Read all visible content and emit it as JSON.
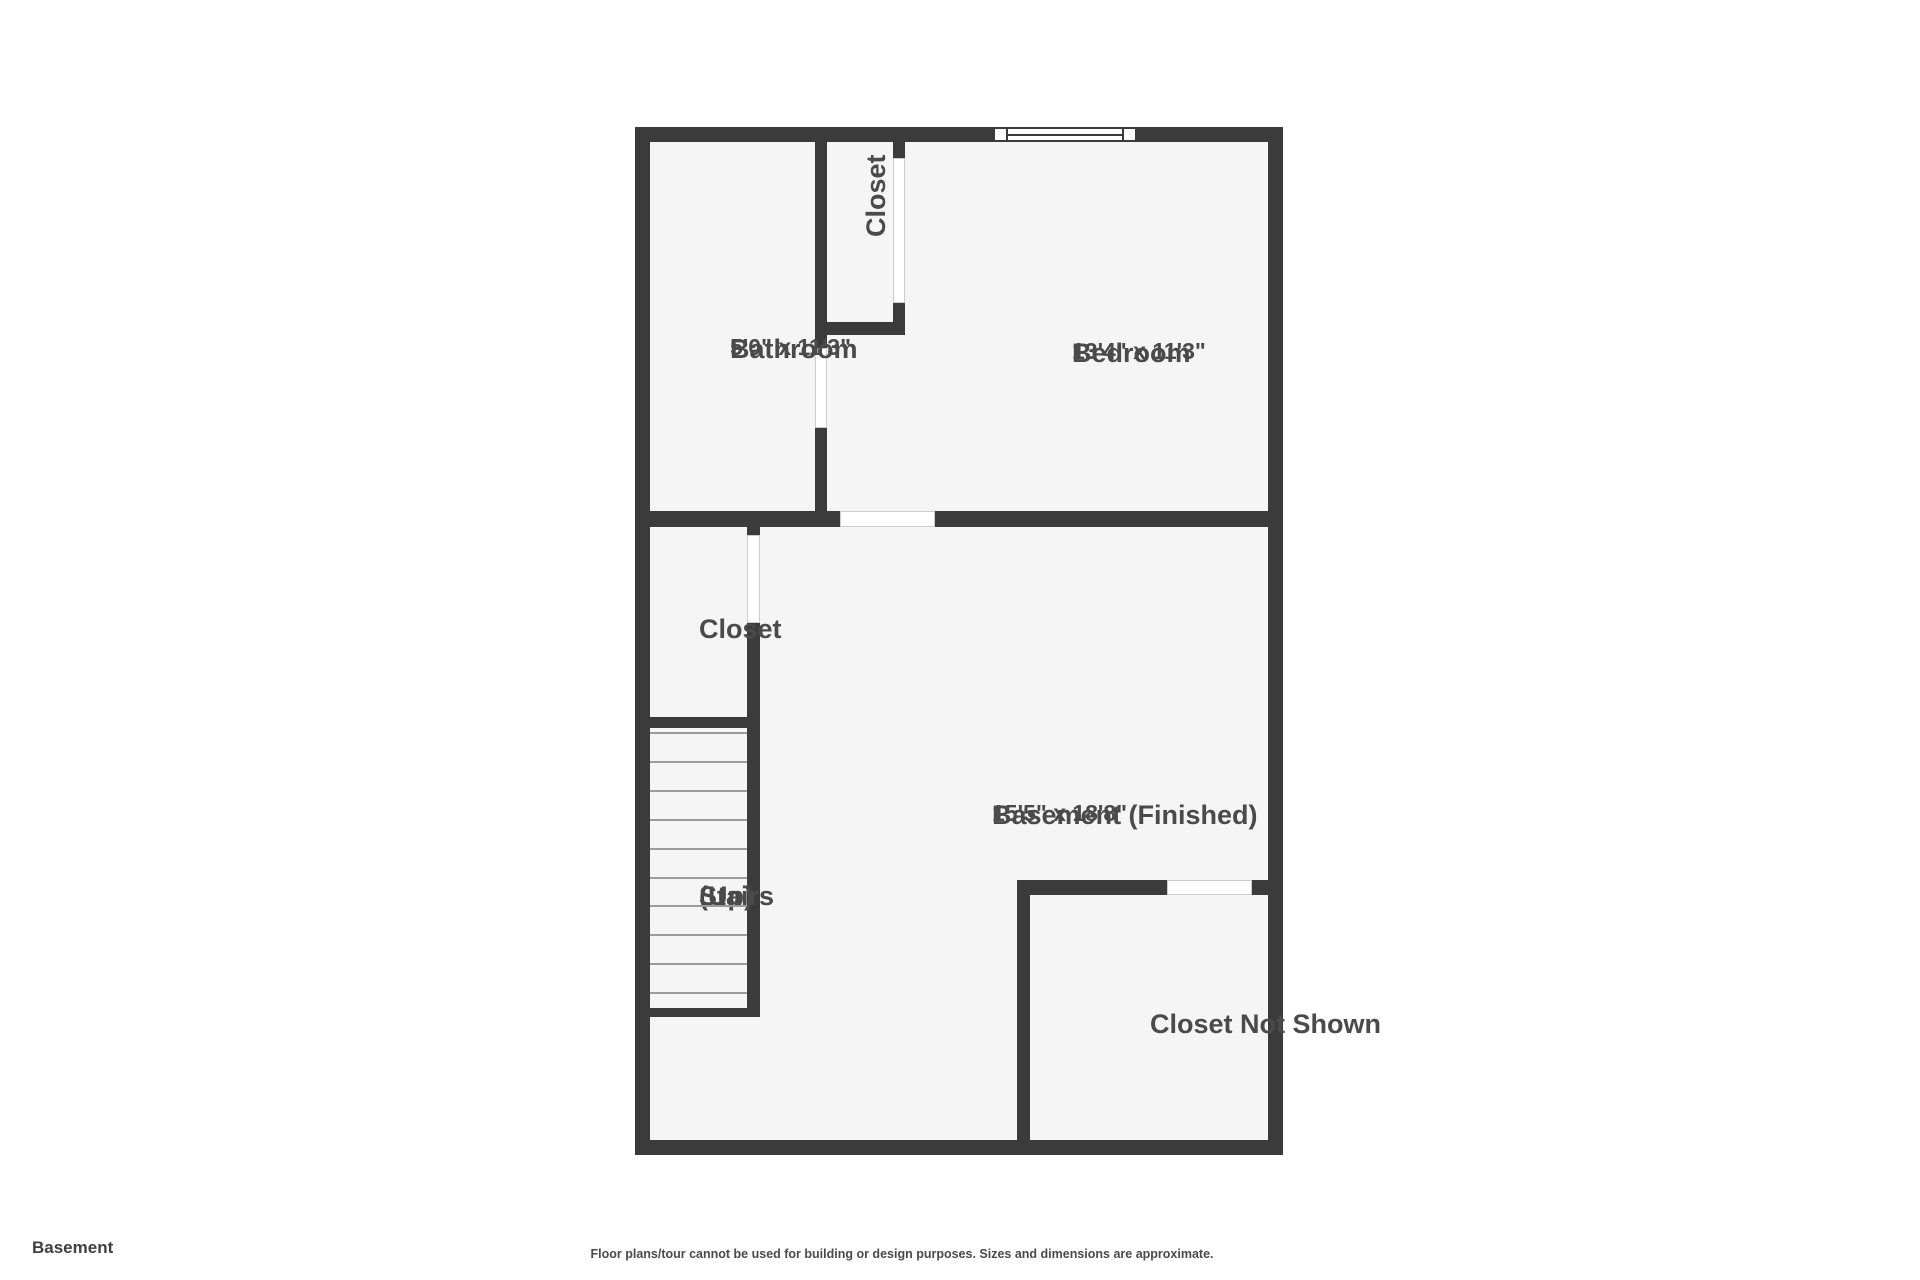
{
  "title": {
    "floor_label": "Basement"
  },
  "footer": {
    "disclaimer": "Floor plans/tour cannot be used for building or design purposes. Sizes and dimensions are approximate."
  },
  "colors": {
    "wall": "#3b3b3b",
    "room_fill": "#f5f5f5",
    "page_bg": "#ffffff",
    "text": "#4a4a4a",
    "tread": "#9b9b9b",
    "opening_border": "#cccccc"
  },
  "plan": {
    "rooms": {
      "bathroom": {
        "name": "Bathroom",
        "dims": "5'0\" x 11'3\""
      },
      "closet_top": {
        "name": "Closet"
      },
      "bedroom": {
        "name": "Bedroom",
        "dims": "13'4\" x 11'3\""
      },
      "closet_mid": {
        "name": "Closet"
      },
      "stairs": {
        "name": "Stairs",
        "qualifier": "(Up)",
        "tread_count": 10
      },
      "basement": {
        "name": "Basement (Finished)",
        "dims": "15'5\" x 18'8\""
      },
      "closet_not_shown": {
        "name": "Closet Not Shown"
      }
    }
  }
}
